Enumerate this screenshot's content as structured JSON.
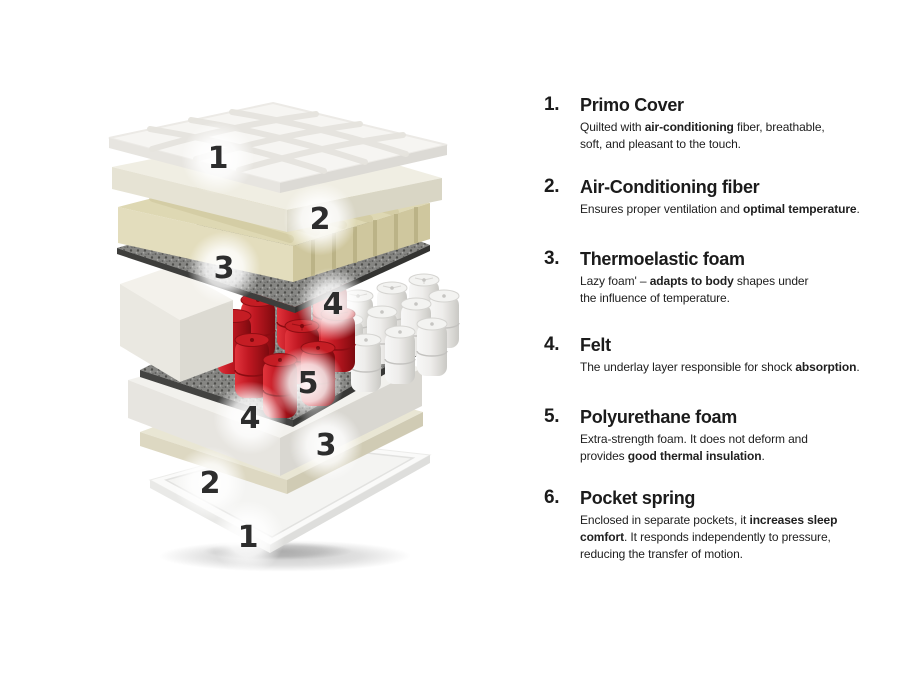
{
  "page": {
    "background": "#ffffff"
  },
  "diagram": {
    "description": "Exploded view of mattress layers",
    "badges": [
      {
        "label": "1"
      },
      {
        "label": "2"
      },
      {
        "label": "3"
      },
      {
        "label": "4"
      },
      {
        "label": "5"
      },
      {
        "label": "4"
      },
      {
        "label": "3"
      },
      {
        "label": "2"
      },
      {
        "label": "1"
      }
    ]
  },
  "list": {
    "items": [
      {
        "num": "1.",
        "title": "Primo Cover",
        "desc": [
          {
            "t": "Quilted with ",
            "b": false
          },
          {
            "t": "air-conditioning",
            "b": true
          },
          {
            "t": " fiber, breathable,\nsoft, and pleasant to the touch.",
            "b": false
          }
        ]
      },
      {
        "num": "2.",
        "title": "Air-Conditioning fiber",
        "desc": [
          {
            "t": "Ensures proper ventilation and ",
            "b": false
          },
          {
            "t": "optimal temperature",
            "b": true
          },
          {
            "t": ".",
            "b": false
          }
        ]
      },
      {
        "num": "3.",
        "title": "Thermoelastic foam",
        "desc": [
          {
            "t": "Lazy foam' – ",
            "b": false
          },
          {
            "t": "adapts to body",
            "b": true
          },
          {
            "t": " shapes under\nthe influence of temperature.",
            "b": false
          }
        ]
      },
      {
        "num": "4.",
        "title": "Felt",
        "desc": [
          {
            "t": "The underlay layer responsible for shock ",
            "b": false
          },
          {
            "t": "absorption",
            "b": true
          },
          {
            "t": ".",
            "b": false
          }
        ]
      },
      {
        "num": "5.",
        "title": "Polyurethane foam",
        "desc": [
          {
            "t": "Extra-strength foam. It does not deform and\nprovides ",
            "b": false
          },
          {
            "t": "good thermal insulation",
            "b": true
          },
          {
            "t": ".",
            "b": false
          }
        ]
      },
      {
        "num": "6.",
        "title": "Pocket spring",
        "desc": [
          {
            "t": "Enclosed in separate pockets, it ",
            "b": false
          },
          {
            "t": "increases sleep\ncomfort",
            "b": true
          },
          {
            "t": ". It responds independently to pressure,\nreducing the transfer of motion.",
            "b": false
          }
        ]
      }
    ]
  },
  "colors": {
    "spring_red": "#b5151c",
    "spring_white": "#ececeb",
    "foam_cream": "#ded8b3",
    "foam_white": "#f2f1ed",
    "felt_gray": "#82827f",
    "badge_text": "#2d2d2d",
    "text": "#1b1b1b"
  }
}
